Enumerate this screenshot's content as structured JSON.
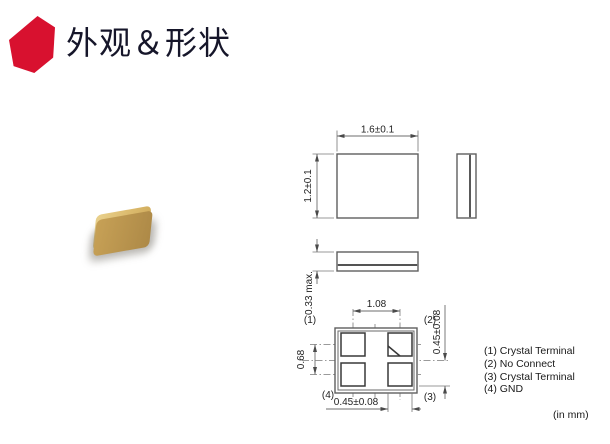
{
  "header": {
    "title": "外观＆形状"
  },
  "colors": {
    "accent": "#d8112f",
    "line_gray": "#5f5f5f",
    "chip_tan": "#dcbb6e"
  },
  "drawing": {
    "top_view": {
      "width_dim": "1.6±0.1",
      "height_dim": "1.2±0.1"
    },
    "side_view": {
      "thickness_dim": "0.33 max."
    },
    "bottom_view": {
      "pitch_x_dim": "1.08",
      "pitch_y_dim": "0.68",
      "pad_width_dim": "0.45±0.08",
      "pad_height_dim": "0.45±0.08",
      "pin_labels": [
        "(1)",
        "(2)",
        "(3)",
        "(4)"
      ]
    },
    "units_note": "(in mm)"
  },
  "legend": {
    "items": [
      "(1) Crystal Terminal",
      "(2) No Connect",
      "(3) Crystal Terminal",
      "(4) GND"
    ]
  }
}
